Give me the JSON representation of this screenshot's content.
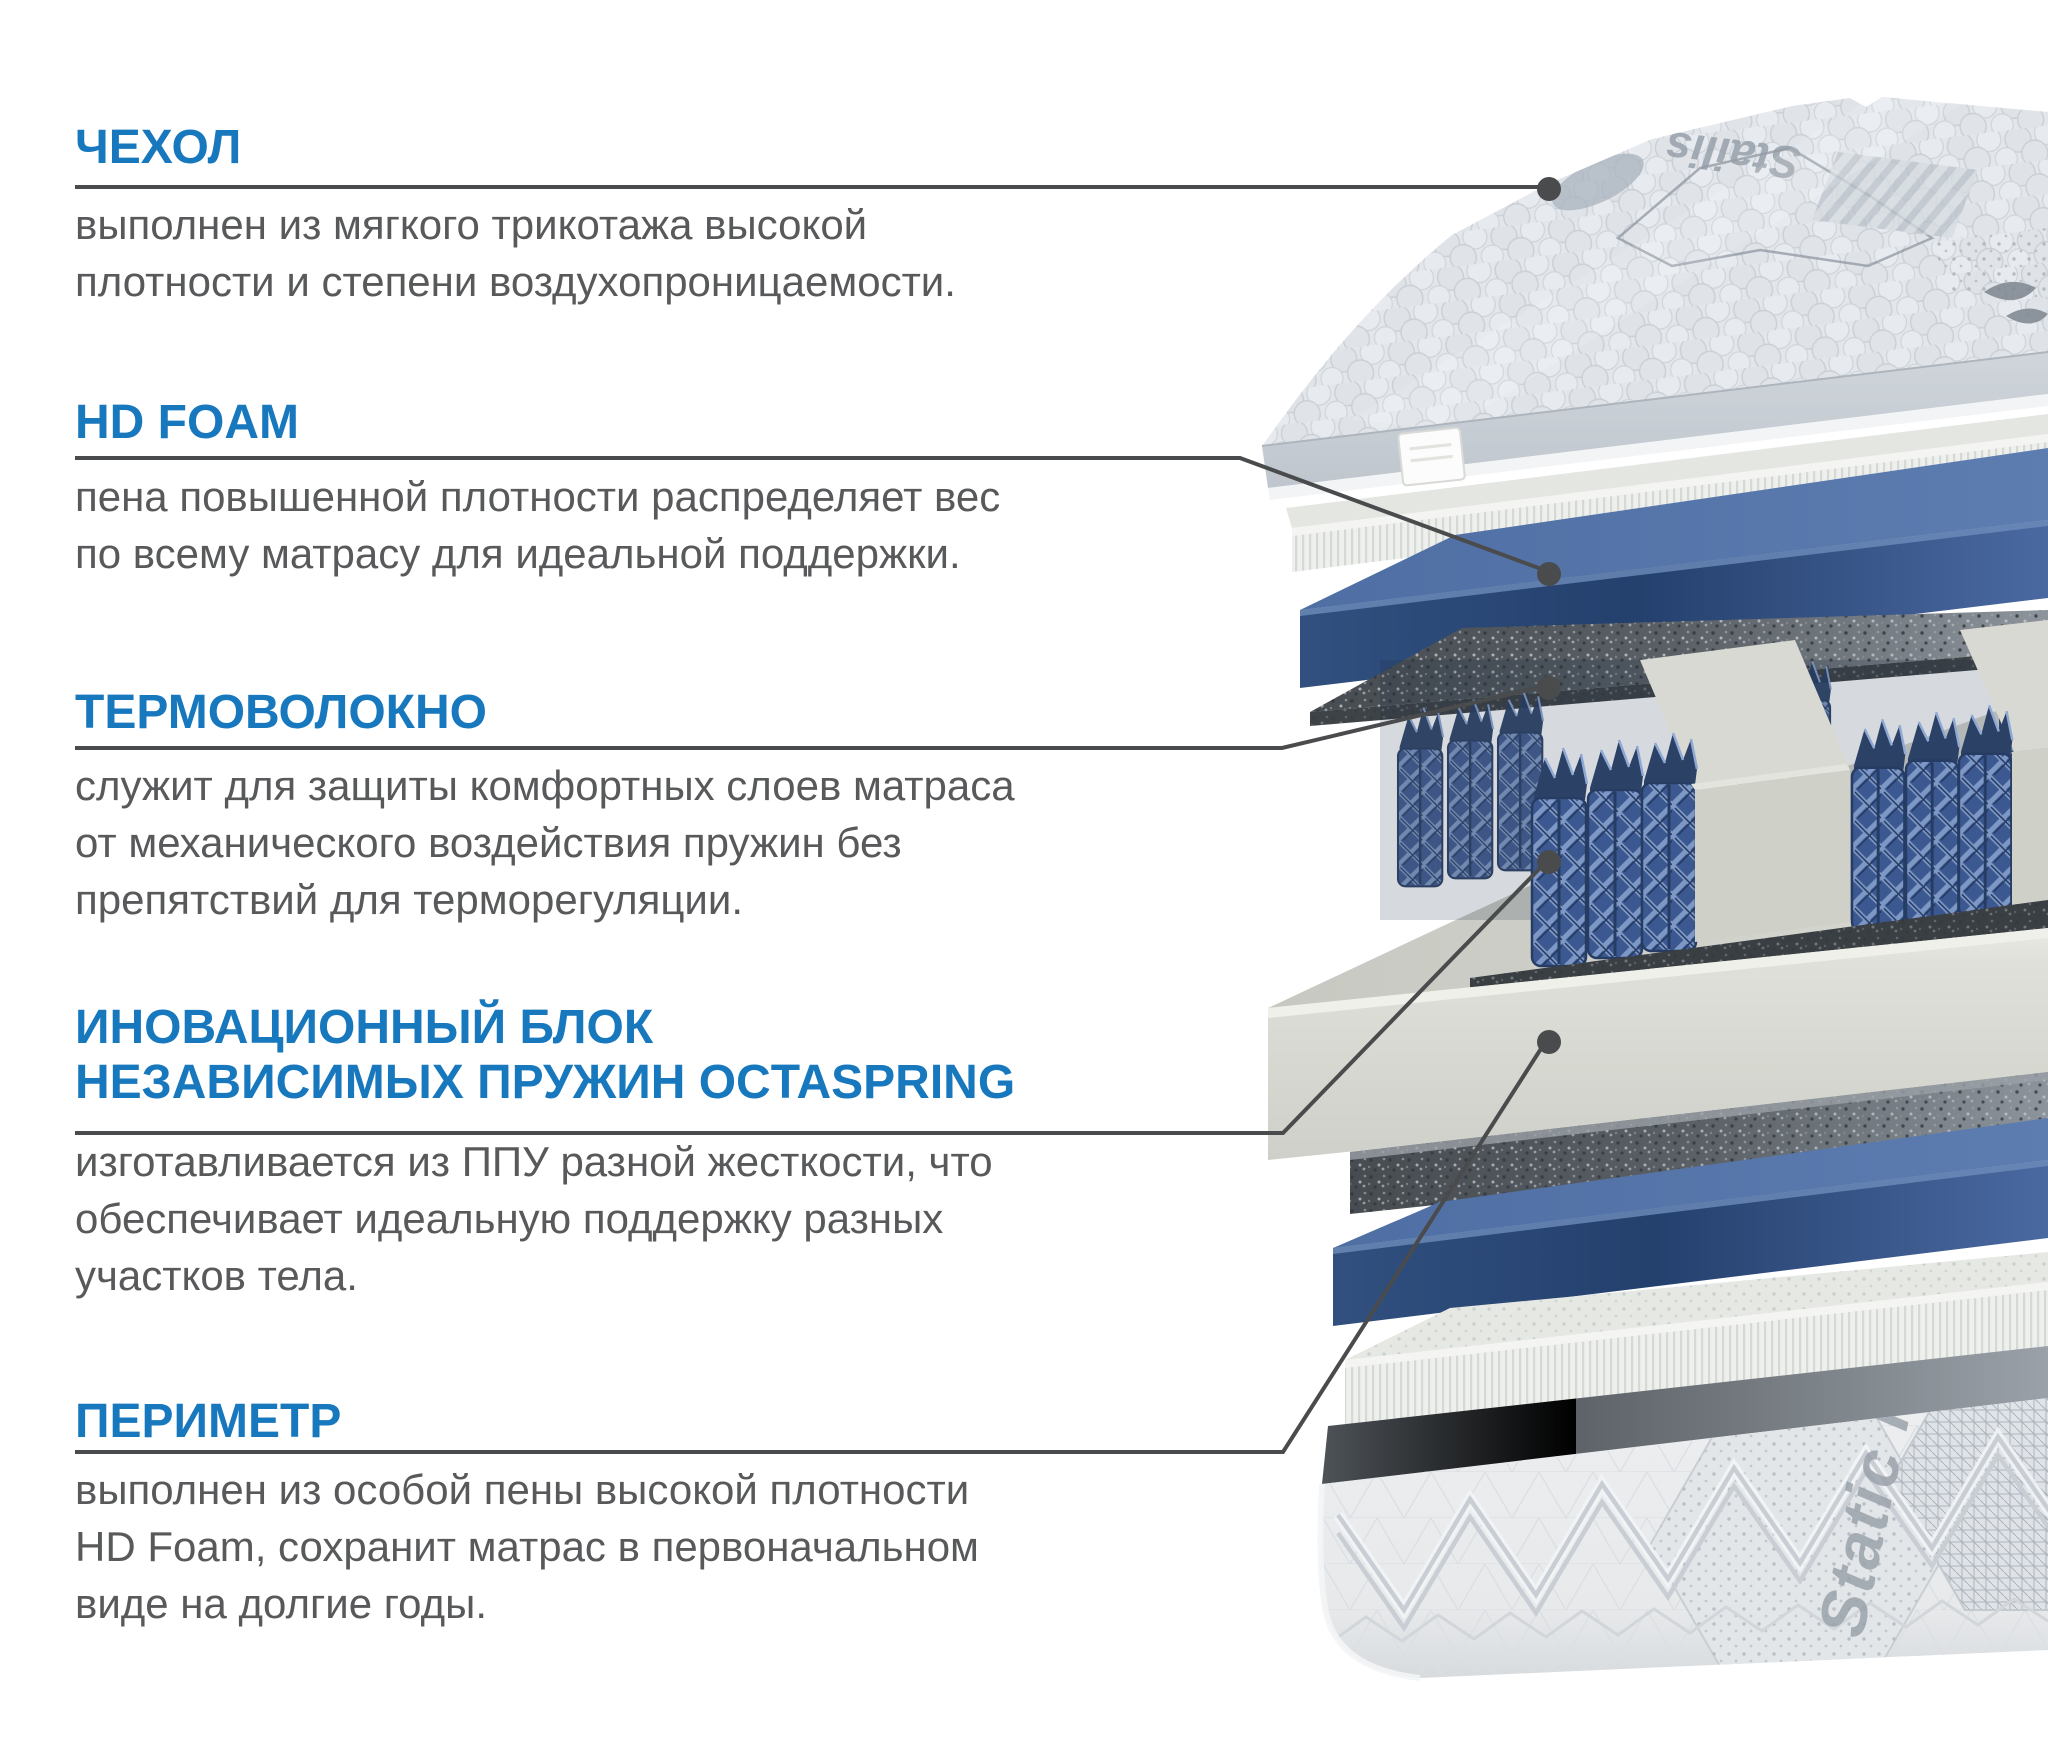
{
  "page": {
    "type": "mattress-layers-infographic",
    "language": "ru",
    "background_color": "#ffffff"
  },
  "colors": {
    "heading_blue": "#1878be",
    "body_text_gray": "#58595b",
    "leader_line_gray": "#4a4b4d",
    "blue_foam": "#4a69a1",
    "blue_foam_dark": "#2e4a77",
    "felt_gray": "#62686e",
    "white_foam": "#eef0ed",
    "frame_white": "#dfe0d9",
    "spring_blue": "#3c5890",
    "spring_highlight": "#7e98c5",
    "cover_fabric": "#e2e6ea",
    "border_fabric": "#e9ebed"
  },
  "sections": [
    {
      "id": "cover",
      "title": "ЧЕХОЛ",
      "description": "выполнен из мягкого трикотажа высокой\nплотности и степени воздухопроницаемости."
    },
    {
      "id": "hd-foam",
      "title": "HD FOAM",
      "description": "пена повышенной плотности распределяет вес\nпо всему матрасу для идеальной поддержки."
    },
    {
      "id": "thermo-fiber",
      "title": "ТЕРМОВОЛОКНО",
      "description": "служит для защиты комфортных слоев матраса\nот механического воздействия пружин без\nпрепятствий для терморегуляции."
    },
    {
      "id": "octaspring-block",
      "title": "ИНОВАЦИОННЫЙ БЛОК\nНЕЗАВИСИМЫХ ПРУЖИН OCTASPRING",
      "description": "изготавливается из ППУ разной жесткости, что\nобеспечивает идеальную поддержку разных\nучастков тела."
    },
    {
      "id": "perimeter",
      "title": "ПЕРИМЕТР",
      "description": "выполнен из особой пены высокой плотности\nHD Foam, сохранит матрас в первоначальном\nвиде на долгие годы."
    }
  ],
  "callouts": [
    {
      "target": "cover-layer",
      "line_points": "75,187 1538,187",
      "dot_transform": "translate(1549,189)"
    },
    {
      "target": "hd-foam-layer",
      "line_points": "75,458 1240,458 1544,570",
      "dot_transform": "translate(1549,574)"
    },
    {
      "target": "thermo-felt-layer",
      "line_points": "75,748 1282,748 1544,686",
      "dot_transform": "translate(1549,688)"
    },
    {
      "target": "octaspring-layer",
      "line_points": "75,1133 1283,1133 1544,864",
      "dot_transform": "translate(1549,862)"
    },
    {
      "target": "perimeter-layer",
      "line_points": "75,1452 1283,1452 1544,1044",
      "dot_transform": "translate(1549,1042)"
    }
  ],
  "illustration": {
    "layers_top_to_bottom": [
      "quilted-cover",
      "hd-foam-white-slab",
      "blue-comfort-foam",
      "thermo-felt-sheet",
      "octaspring-block-with-foam-frame",
      "thermo-felt-sheet-2",
      "blue-comfort-foam-2",
      "hd-foam-white-slab-2",
      "perimeter-quilted-base"
    ],
    "cover_embroidery_text": "Stailis",
    "border_embroidery_text": "Static Free"
  }
}
